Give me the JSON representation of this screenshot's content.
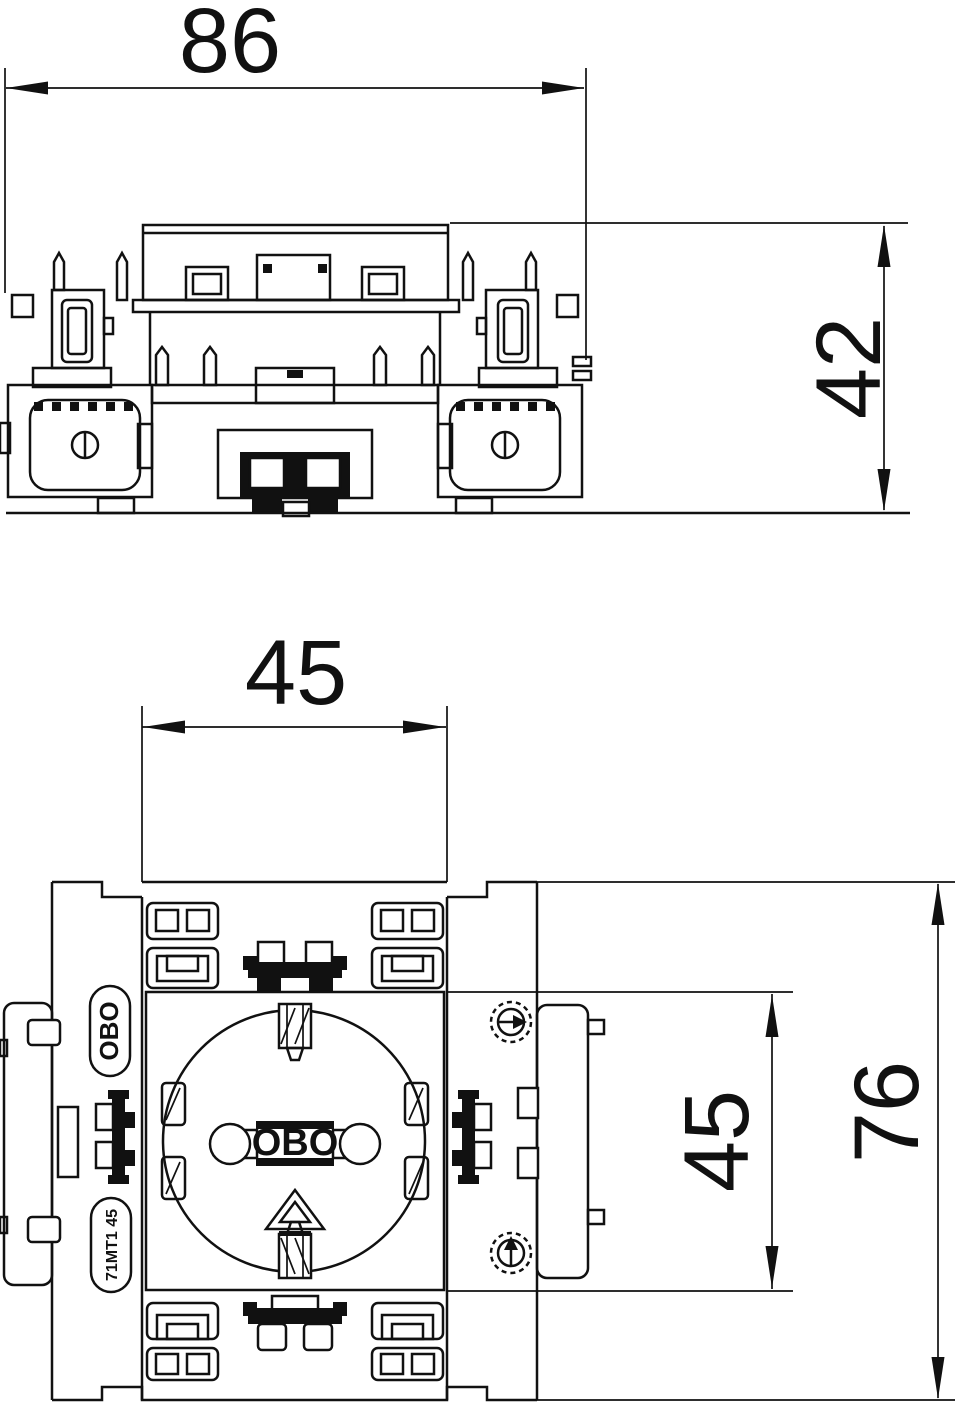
{
  "drawing": {
    "dim_top_width": "86",
    "dim_side_height": "42",
    "dim_module_width": "45",
    "dim_module_height": "45",
    "dim_plate_height": "76",
    "brand_badge": "OBO",
    "model_badge": "71MT1 45",
    "center_logo": "OBO",
    "colors": {
      "line": "#111111",
      "background": "#ffffff"
    }
  }
}
